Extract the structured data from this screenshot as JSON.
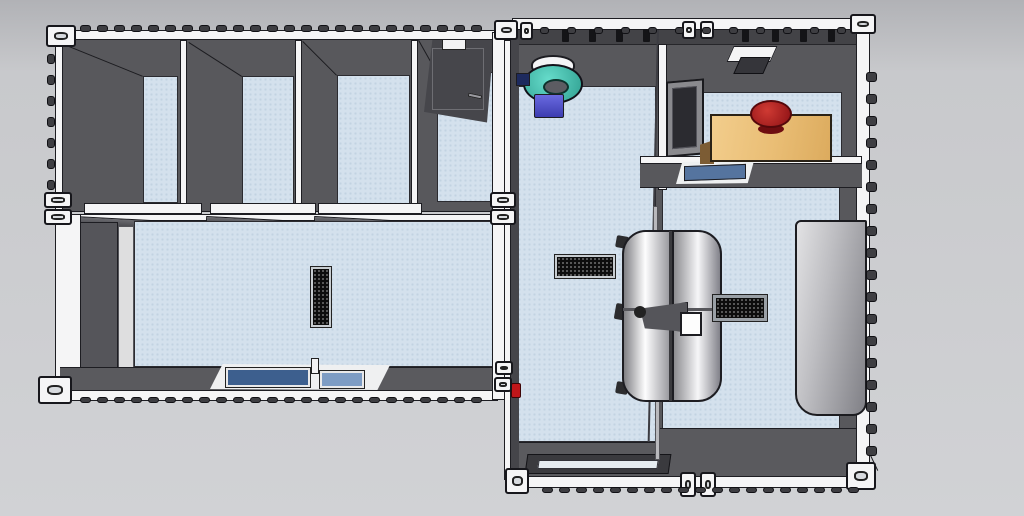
{
  "scene_title": "container-clinic-stable-floorplan-top-view",
  "colors": {
    "bg_top": "#b1b2b6",
    "bg_mid": "#c8c9cc",
    "bg_bot": "#d1d2d5",
    "floor": "#d4e1ed",
    "floor_dot": "#c2d3e2",
    "wall_dark": "#58585c",
    "wall_mid": "#6a6a6e",
    "roof_band": "#434347",
    "frame_white": "#f5f5f6",
    "corrugation": "#3e3e42",
    "window_dark_blue": "#3d5f8e",
    "window_light_blue": "#7d9cc4",
    "skylight_blue": "#55749f",
    "glass_dark": "#2b2b30",
    "wood": "#eec27d",
    "wood_side": "#7c5c34",
    "chair_red": "#b1201f",
    "chair_red_dark": "#6e0d10",
    "teal": "#45c4b3",
    "purple": "#5156c6",
    "extinguisher_red": "#c0161a",
    "steel_light": "#f2f2f4",
    "steel_dark": "#85858a",
    "bench_light": "#e2e2e4",
    "bench_dark": "#808086"
  },
  "components": {
    "left_building": "stable-container-block",
    "right_building": "clinic-container-block",
    "stall": "stall-compartment",
    "corridor": "open-corridor",
    "exam_table": "stainless-exam-table",
    "office": "office-room",
    "sink_unit": "round-sink-lamp-unit",
    "bench": "storage-bench",
    "drain": "floor-drain-grille",
    "vent": "wall-vent-grille"
  },
  "castings": [
    {
      "x": 46,
      "y": 25,
      "w": 30,
      "h": 22
    },
    {
      "x": 44,
      "y": 192,
      "w": 28,
      "h": 16
    },
    {
      "x": 44,
      "y": 209,
      "w": 28,
      "h": 16
    },
    {
      "x": 38,
      "y": 376,
      "w": 34,
      "h": 28
    },
    {
      "x": 490,
      "y": 192,
      "w": 26,
      "h": 16
    },
    {
      "x": 490,
      "y": 209,
      "w": 26,
      "h": 16
    },
    {
      "x": 494,
      "y": 20,
      "w": 24,
      "h": 20
    },
    {
      "x": 520,
      "y": 22,
      "w": 13,
      "h": 18
    },
    {
      "x": 682,
      "y": 21,
      "w": 14,
      "h": 18
    },
    {
      "x": 700,
      "y": 21,
      "w": 14,
      "h": 18
    },
    {
      "x": 850,
      "y": 14,
      "w": 26,
      "h": 20
    },
    {
      "x": 495,
      "y": 361,
      "w": 18,
      "h": 14
    },
    {
      "x": 494,
      "y": 377,
      "w": 18,
      "h": 15
    },
    {
      "x": 505,
      "y": 468,
      "w": 24,
      "h": 26
    },
    {
      "x": 680,
      "y": 472,
      "w": 16,
      "h": 25
    },
    {
      "x": 700,
      "y": 472,
      "w": 16,
      "h": 25
    },
    {
      "x": 846,
      "y": 462,
      "w": 30,
      "h": 28
    }
  ],
  "bump_rails": [
    {
      "x": 80,
      "y": 25,
      "count": 24,
      "dx": 17,
      "dy": 0,
      "w": 11,
      "h": 7
    },
    {
      "x": 47,
      "y": 54,
      "count": 7,
      "dx": 0,
      "dy": 21,
      "w": 8,
      "h": 10
    },
    {
      "x": 80,
      "y": 397,
      "count": 24,
      "dx": 17,
      "dy": 0,
      "w": 11,
      "h": 6
    },
    {
      "x": 866,
      "y": 72,
      "count": 18,
      "dx": 0,
      "dy": 22,
      "w": 11,
      "h": 10
    },
    {
      "x": 542,
      "y": 487,
      "count": 19,
      "dx": 17,
      "dy": 0,
      "w": 11,
      "h": 6
    },
    {
      "x": 540,
      "y": 27,
      "count": 12,
      "dx": 27,
      "dy": 0,
      "w": 9,
      "h": 7
    }
  ],
  "roof_brackets": [
    562,
    589,
    616,
    643,
    742,
    772,
    800,
    828
  ],
  "stalls": {
    "floors": [
      {
        "x": 143,
        "y": 76,
        "w": 35,
        "h": 127
      },
      {
        "x": 242,
        "y": 76,
        "w": 52,
        "h": 128
      },
      {
        "x": 337,
        "y": 75,
        "w": 73,
        "h": 129
      },
      {
        "x": 437,
        "y": 72,
        "w": 57,
        "h": 130
      }
    ],
    "dividers": [
      {
        "x": 180,
        "y": 40,
        "w": 7,
        "h": 168
      },
      {
        "x": 295,
        "y": 40,
        "w": 7,
        "h": 167
      },
      {
        "x": 411,
        "y": 40,
        "w": 7,
        "h": 166
      }
    ],
    "sills": [
      {
        "x": 84,
        "y": 203,
        "w": 118,
        "h": 11
      },
      {
        "x": 210,
        "y": 203,
        "w": 106,
        "h": 11
      },
      {
        "x": 318,
        "y": 203,
        "w": 104,
        "h": 11
      }
    ],
    "gates": [
      {
        "x": 74,
        "y": 216,
        "w": 140,
        "h": 10,
        "deg": 3
      },
      {
        "x": 206,
        "y": 216,
        "w": 122,
        "h": 9,
        "deg": 3
      },
      {
        "x": 314,
        "y": 216,
        "w": 112,
        "h": 9,
        "deg": 3
      }
    ]
  },
  "diagonals": [
    {
      "x": 64,
      "y": 44,
      "len": 85,
      "deg": 22.0
    },
    {
      "x": 189,
      "y": 42,
      "len": 63,
      "deg": 32.7
    },
    {
      "x": 303,
      "y": 41,
      "len": 48,
      "deg": 45.0
    },
    {
      "x": 419,
      "y": 40,
      "len": 37,
      "deg": 60.6
    },
    {
      "x": 710,
      "y": 45,
      "len": 56,
      "deg": 57.4
    },
    {
      "x": 858,
      "y": 428,
      "len": 47,
      "deg": 64.5
    }
  ]
}
